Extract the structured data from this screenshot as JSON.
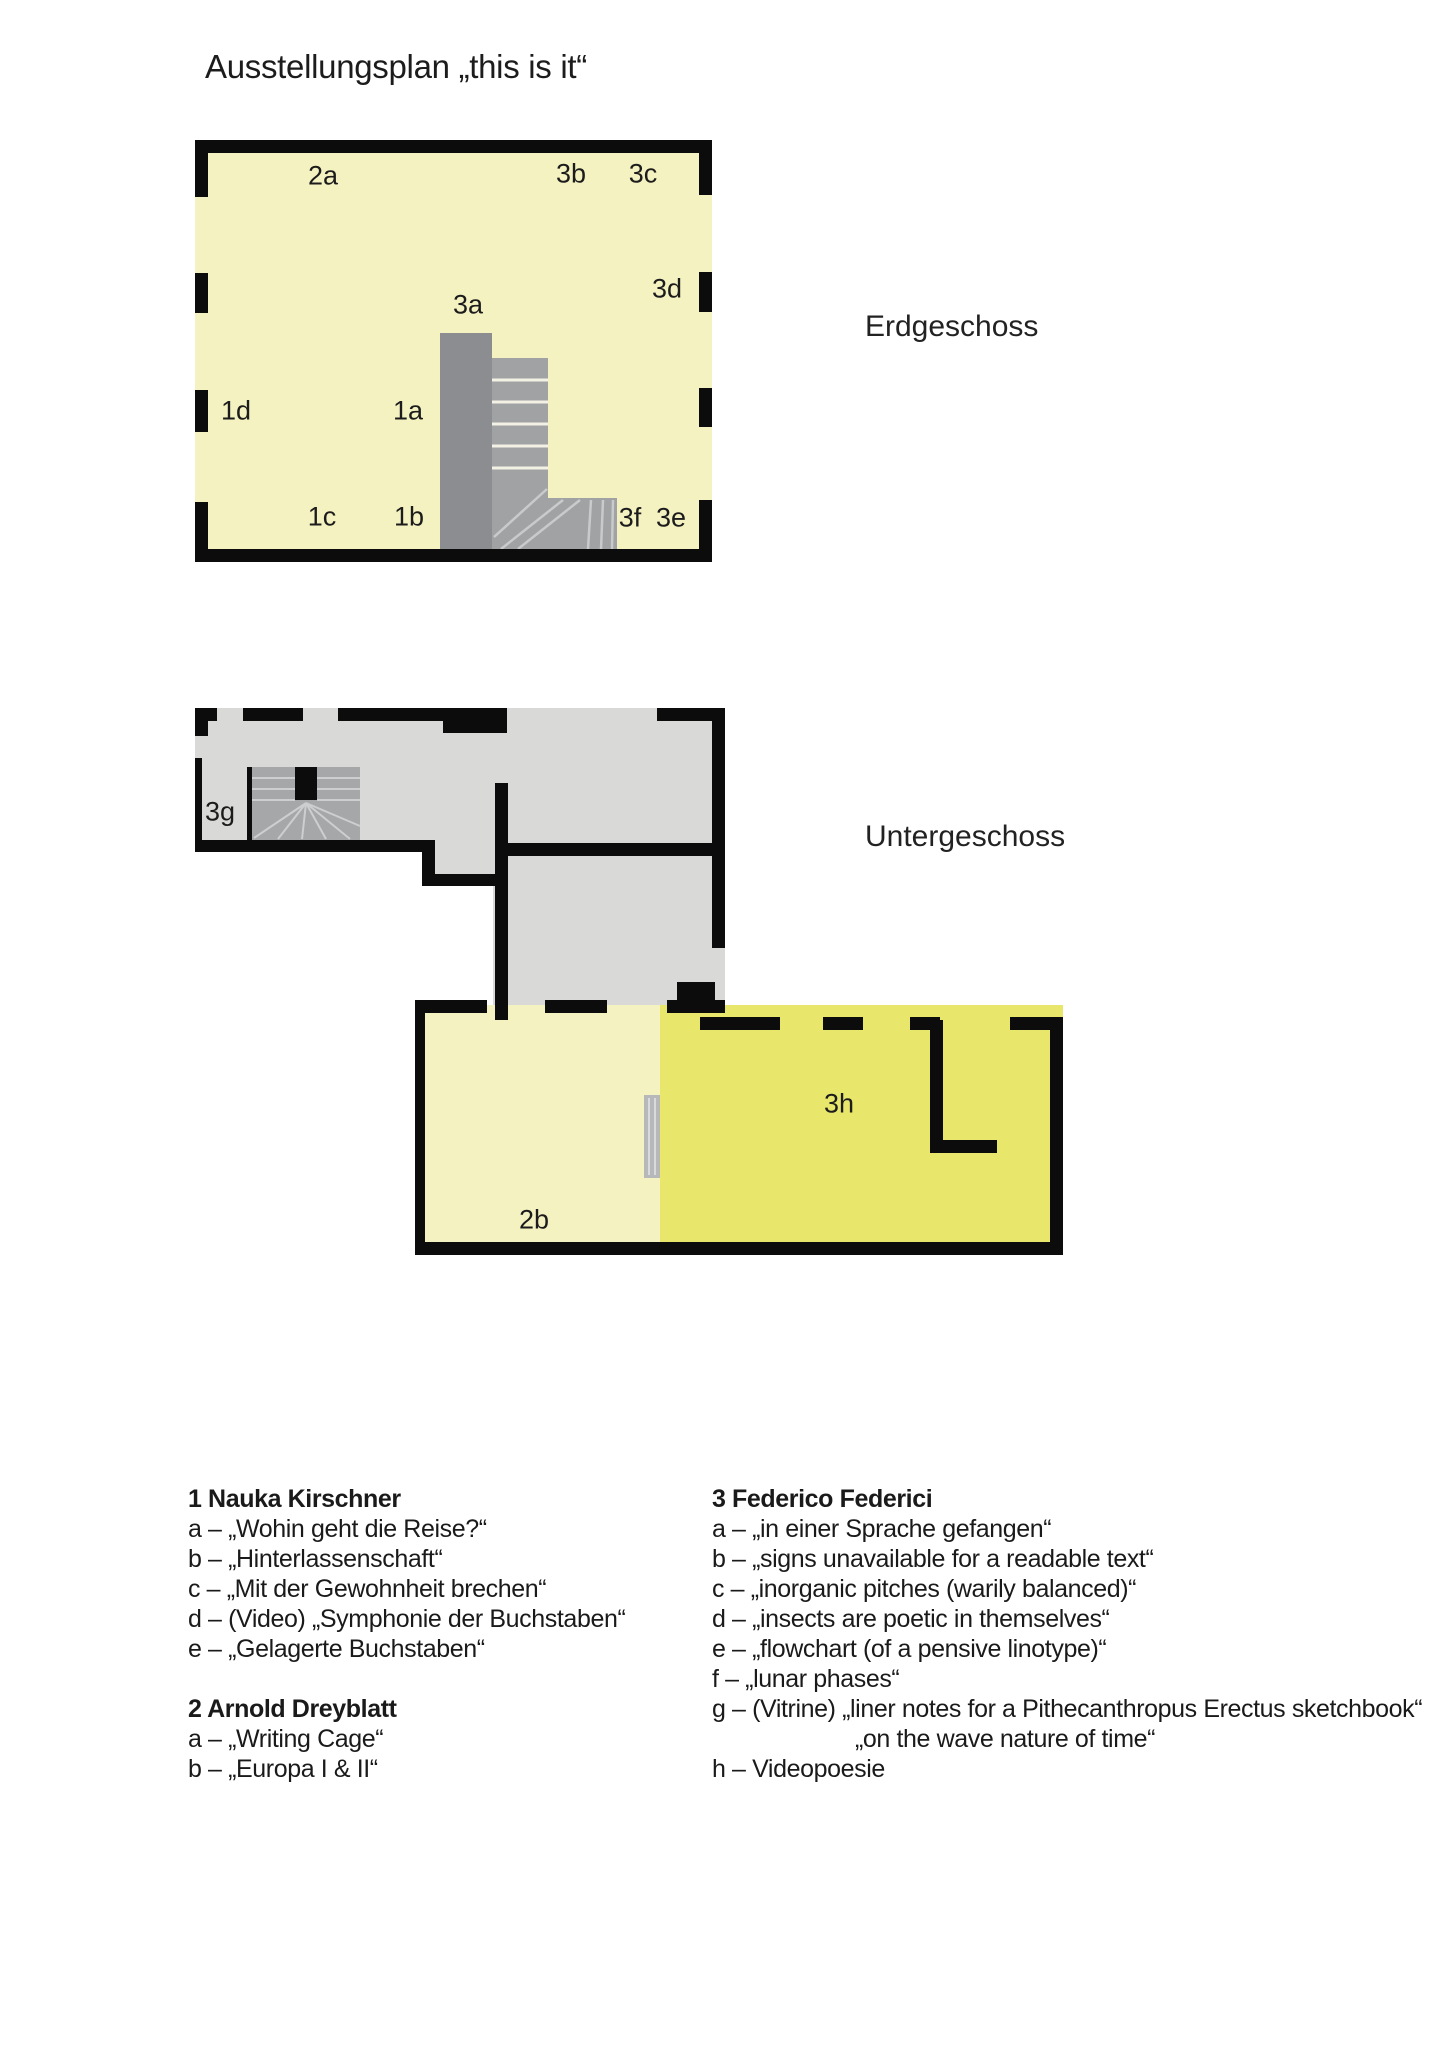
{
  "page": {
    "title": "Ausstellungsplan „this is it“"
  },
  "colors": {
    "wall": "#0c0c0c",
    "pale_yellow": "#f5f2c1",
    "bright_yellow": "#e9e66c",
    "floor_gray": "#d9d9d7",
    "stair_dark": "#8b8d90",
    "stair_mid": "#a0a2a4",
    "stair_light": "#a6a7a9",
    "door_gray": "#b7b8ba"
  },
  "floors": [
    {
      "id": "erdgeschoss",
      "name": "Erdgeschoss",
      "labels": [
        {
          "text": "2a",
          "x": 128,
          "y": 36
        },
        {
          "text": "3b",
          "x": 376,
          "y": 34
        },
        {
          "text": "3c",
          "x": 448,
          "y": 34
        },
        {
          "text": "3a",
          "x": 273,
          "y": 165
        },
        {
          "text": "3d",
          "x": 472,
          "y": 149
        },
        {
          "text": "1d",
          "x": 41,
          "y": 271
        },
        {
          "text": "1a",
          "x": 213,
          "y": 271
        },
        {
          "text": "1c",
          "x": 127,
          "y": 377
        },
        {
          "text": "1b",
          "x": 214,
          "y": 377
        },
        {
          "text": "3f",
          "x": 435,
          "y": 378
        },
        {
          "text": "3e",
          "x": 476,
          "y": 378
        }
      ]
    },
    {
      "id": "untergeschoss",
      "name": "Untergeschoss",
      "labels": [
        {
          "text": "3g",
          "x": 25,
          "y": 104
        },
        {
          "text": "3h",
          "x": 644,
          "y": 396
        },
        {
          "text": "2b",
          "x": 339,
          "y": 512
        }
      ]
    }
  ],
  "legend": {
    "columns": [
      {
        "groups": [
          {
            "header": "1 Nauka Kirschner",
            "items": [
              {
                "text": "a – „Wohin geht die Reise?“"
              },
              {
                "text": "b – „Hinterlassenschaft“"
              },
              {
                "text": "c  – „Mit der Gewohnheit brechen“"
              },
              {
                "text": "d – (Video) „Symphonie der Buchstaben“"
              },
              {
                "text": "e – „Gelagerte Buchstaben“"
              }
            ]
          },
          {
            "header": "2 Arnold Dreyblatt",
            "items": [
              {
                "text": "a –  „Writing Cage“"
              },
              {
                "text": "b – „Europa I & II“"
              }
            ]
          }
        ]
      },
      {
        "groups": [
          {
            "header": "3 Federico Federici",
            "items": [
              {
                "text": "a –  „in einer Sprache gefangen“"
              },
              {
                "text": "b – „signs unavailable for a readable text“"
              },
              {
                "text": "c – „inorganic pitches (warily balanced)“"
              },
              {
                "text": "d – „insects are poetic in themselves“"
              },
              {
                "text": "e – „flowchart (of a pensive linotype)“"
              },
              {
                "text": "f – „lunar phases“"
              },
              {
                "text": "g – (Vitrine) „liner notes for a Pithecanthropus Erectus sketchbook“"
              },
              {
                "text": "„on the wave nature of time“",
                "indent": true
              },
              {
                "text": "h – Videopoesie"
              }
            ]
          }
        ]
      }
    ]
  }
}
